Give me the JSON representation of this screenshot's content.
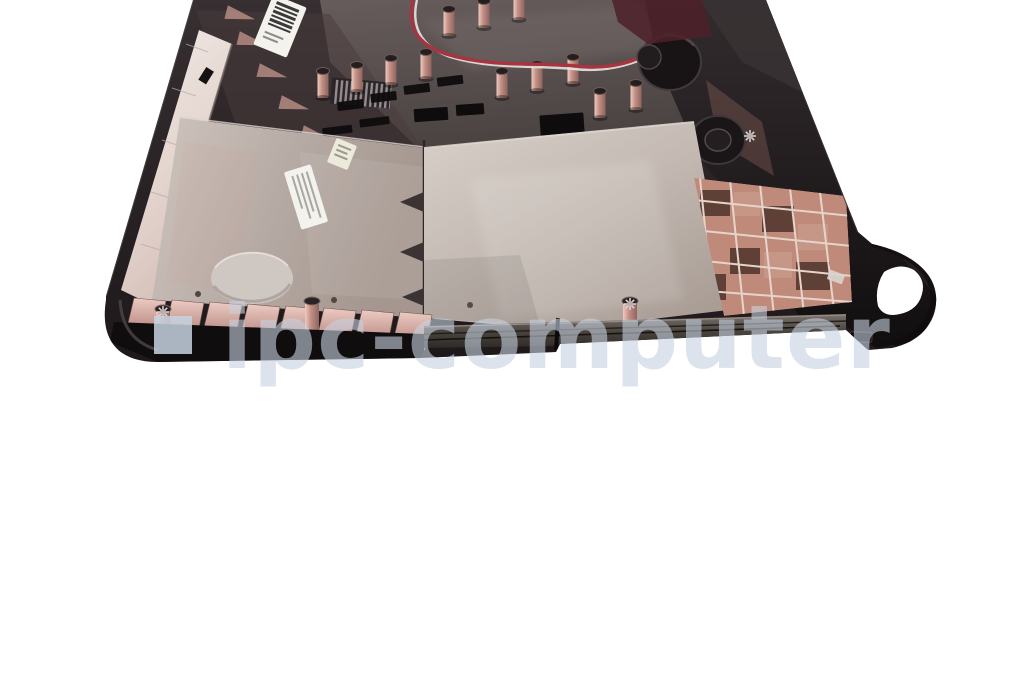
{
  "watermark": {
    "text": "ipc-computer",
    "logo_shape": "square"
  },
  "colors": {
    "background": "#ffffff",
    "case_black": "#221d1f",
    "rim_strip": "#ece4e0",
    "panel_metal_left": "#bdb1ab",
    "panel_metal_center": "#c8bfb8",
    "copper_shield": "#c08a7a",
    "rib_pink": "#d8b3ab",
    "wire_red": "#a93340",
    "wire_white": "#e8e4e0",
    "label_white": "#f3f2ed",
    "fan_black": "#181315",
    "watermark_blue": "#c7d2e0",
    "divider": "#cbcbcb"
  }
}
